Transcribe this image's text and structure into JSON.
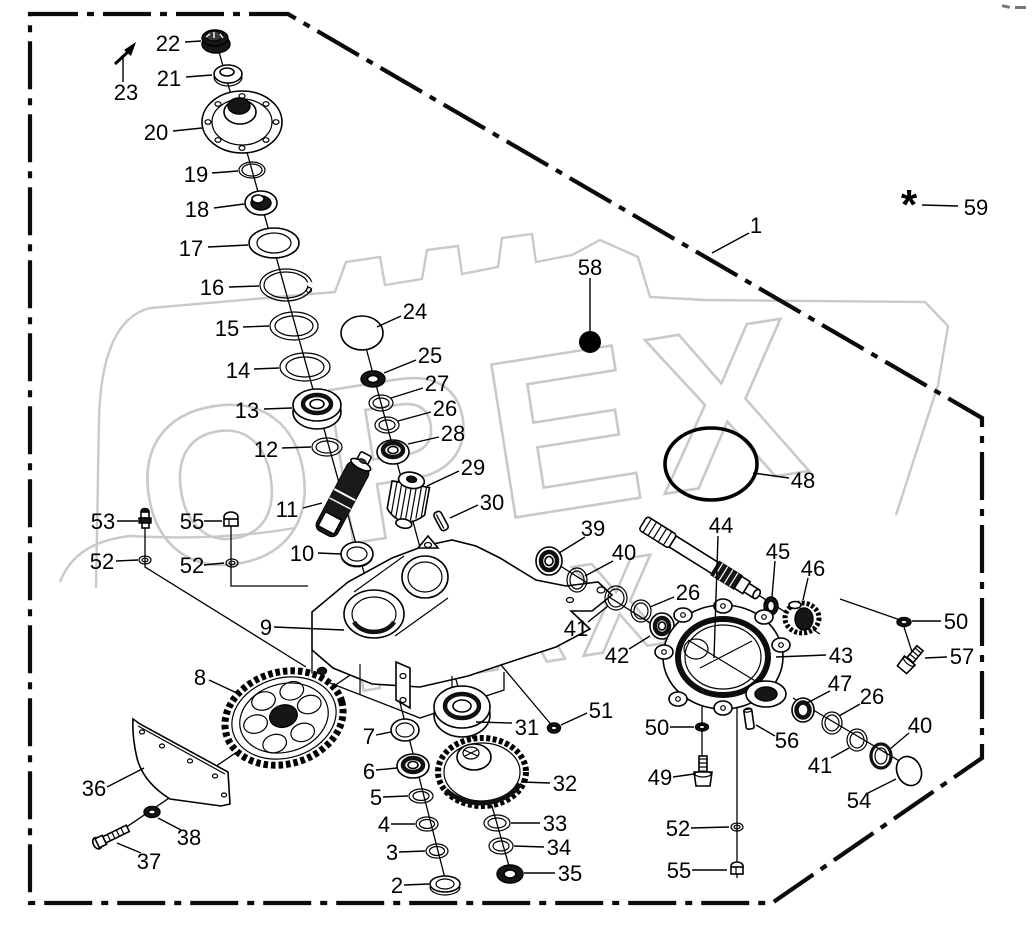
{
  "diagram": {
    "type": "exploded-parts-diagram",
    "subject": "gearbox assembly",
    "border_style": "dash-dot",
    "line_color": "#000000",
    "background": "#ffffff"
  },
  "watermark": {
    "line1": "OPEX",
    "line2": "MAX",
    "color": "#c9c9c9"
  },
  "footnote": {
    "symbol": "*"
  },
  "labels": [
    {
      "n": "22",
      "x": 168,
      "y": 43,
      "x1": 185,
      "y1": 42,
      "x2": 201,
      "y2": 41
    },
    {
      "n": "21",
      "x": 169,
      "y": 78,
      "x1": 186,
      "y1": 77,
      "x2": 212,
      "y2": 75
    },
    {
      "n": "23",
      "x": 126,
      "y": 92,
      "x1": 123,
      "y1": 82,
      "x2": 123,
      "y2": 58
    },
    {
      "n": "20",
      "x": 156,
      "y": 132,
      "x1": 173,
      "y1": 131,
      "x2": 202,
      "y2": 128
    },
    {
      "n": "19",
      "x": 196,
      "y": 174,
      "x1": 212,
      "y1": 173,
      "x2": 238,
      "y2": 171
    },
    {
      "n": "18",
      "x": 197,
      "y": 209,
      "x1": 214,
      "y1": 208,
      "x2": 244,
      "y2": 204
    },
    {
      "n": "17",
      "x": 191,
      "y": 248,
      "x1": 208,
      "y1": 247,
      "x2": 248,
      "y2": 245
    },
    {
      "n": "16",
      "x": 212,
      "y": 287,
      "x1": 229,
      "y1": 287,
      "x2": 259,
      "y2": 286
    },
    {
      "n": "15",
      "x": 227,
      "y": 328,
      "x1": 243,
      "y1": 327,
      "x2": 269,
      "y2": 326
    },
    {
      "n": "14",
      "x": 238,
      "y": 370,
      "x1": 254,
      "y1": 369,
      "x2": 279,
      "y2": 368
    },
    {
      "n": "13",
      "x": 247,
      "y": 410,
      "x1": 264,
      "y1": 409,
      "x2": 292,
      "y2": 408
    },
    {
      "n": "12",
      "x": 266,
      "y": 449,
      "x1": 282,
      "y1": 448,
      "x2": 311,
      "y2": 447
    },
    {
      "n": "11",
      "x": 287,
      "y": 509,
      "x1": 303,
      "y1": 508,
      "x2": 322,
      "y2": 503
    },
    {
      "n": "10",
      "x": 302,
      "y": 553,
      "x1": 318,
      "y1": 553,
      "x2": 341,
      "y2": 554
    },
    {
      "n": "24",
      "x": 415,
      "y": 311,
      "x1": 401,
      "y1": 316,
      "x2": 377,
      "y2": 327
    },
    {
      "n": "25",
      "x": 430,
      "y": 355,
      "x1": 416,
      "y1": 360,
      "x2": 384,
      "y2": 373
    },
    {
      "n": "27",
      "x": 437,
      "y": 383,
      "x1": 423,
      "y1": 388,
      "x2": 391,
      "y2": 398
    },
    {
      "n": "26",
      "x": 445,
      "y": 408,
      "x1": 431,
      "y1": 412,
      "x2": 398,
      "y2": 421
    },
    {
      "n": "28",
      "x": 453,
      "y": 433,
      "x1": 439,
      "y1": 437,
      "x2": 408,
      "y2": 444
    },
    {
      "n": "29",
      "x": 473,
      "y": 467,
      "x1": 459,
      "y1": 471,
      "x2": 427,
      "y2": 486
    },
    {
      "n": "30",
      "x": 492,
      "y": 502,
      "x1": 478,
      "y1": 505,
      "x2": 450,
      "y2": 518
    },
    {
      "n": "9",
      "x": 266,
      "y": 627,
      "x1": 274,
      "y1": 627,
      "x2": 344,
      "y2": 630
    },
    {
      "n": "53",
      "x": 103,
      "y": 521,
      "x1": 117,
      "y1": 521,
      "x2": 138,
      "y2": 521
    },
    {
      "n": "52",
      "x": 102,
      "y": 561,
      "x1": 116,
      "y1": 561,
      "x2": 138,
      "y2": 560
    },
    {
      "n": "55",
      "x": 192,
      "y": 521,
      "x1": 204,
      "y1": 521,
      "x2": 222,
      "y2": 521
    },
    {
      "n": "52",
      "x": 192,
      "y": 565,
      "x1": 204,
      "y1": 565,
      "x2": 224,
      "y2": 563
    },
    {
      "n": "8",
      "x": 200,
      "y": 677,
      "x1": 209,
      "y1": 680,
      "x2": 239,
      "y2": 694
    },
    {
      "n": "36",
      "x": 94,
      "y": 788,
      "x1": 107,
      "y1": 787,
      "x2": 144,
      "y2": 768
    },
    {
      "n": "38",
      "x": 189,
      "y": 837,
      "x1": 181,
      "y1": 830,
      "x2": 158,
      "y2": 818
    },
    {
      "n": "37",
      "x": 149,
      "y": 861,
      "x1": 141,
      "y1": 853,
      "x2": 117,
      "y2": 843
    },
    {
      "n": "7",
      "x": 369,
      "y": 736,
      "x1": 376,
      "y1": 735,
      "x2": 391,
      "y2": 732
    },
    {
      "n": "6",
      "x": 369,
      "y": 771,
      "x1": 376,
      "y1": 770,
      "x2": 397,
      "y2": 768
    },
    {
      "n": "5",
      "x": 376,
      "y": 797,
      "x1": 383,
      "y1": 797,
      "x2": 408,
      "y2": 796
    },
    {
      "n": "4",
      "x": 384,
      "y": 824,
      "x1": 391,
      "y1": 824,
      "x2": 415,
      "y2": 824
    },
    {
      "n": "3",
      "x": 392,
      "y": 852,
      "x1": 399,
      "y1": 852,
      "x2": 425,
      "y2": 851
    },
    {
      "n": "2",
      "x": 397,
      "y": 885,
      "x1": 404,
      "y1": 885,
      "x2": 429,
      "y2": 884
    },
    {
      "n": "31",
      "x": 527,
      "y": 727,
      "x1": 512,
      "y1": 723,
      "x2": 476,
      "y2": 722
    },
    {
      "n": "32",
      "x": 565,
      "y": 783,
      "x1": 550,
      "y1": 783,
      "x2": 521,
      "y2": 782
    },
    {
      "n": "33",
      "x": 555,
      "y": 823,
      "x1": 540,
      "y1": 823,
      "x2": 511,
      "y2": 823
    },
    {
      "n": "34",
      "x": 559,
      "y": 847,
      "x1": 544,
      "y1": 847,
      "x2": 514,
      "y2": 846
    },
    {
      "n": "35",
      "x": 570,
      "y": 873,
      "x1": 555,
      "y1": 873,
      "x2": 524,
      "y2": 873
    },
    {
      "n": "51",
      "x": 601,
      "y": 710,
      "x1": 587,
      "y1": 713,
      "x2": 561,
      "y2": 725
    },
    {
      "n": "58",
      "x": 590,
      "y": 267,
      "x1": 590,
      "y1": 278,
      "x2": 590,
      "y2": 331
    },
    {
      "n": "1",
      "x": 756,
      "y": 225,
      "x1": 749,
      "y1": 233,
      "x2": 712,
      "y2": 253
    },
    {
      "n": "59",
      "x": 976,
      "y": 207,
      "x1": 958,
      "y1": 206,
      "x2": 922,
      "y2": 205
    },
    {
      "n": "48",
      "x": 803,
      "y": 480,
      "x1": 789,
      "y1": 478,
      "x2": 753,
      "y2": 473
    },
    {
      "n": "39",
      "x": 593,
      "y": 528,
      "x1": 585,
      "y1": 537,
      "x2": 559,
      "y2": 553
    },
    {
      "n": "40",
      "x": 624,
      "y": 552,
      "x1": 613,
      "y1": 561,
      "x2": 585,
      "y2": 576
    },
    {
      "n": "41",
      "x": 576,
      "y": 628,
      "x1": 588,
      "y1": 622,
      "x2": 608,
      "y2": 606
    },
    {
      "n": "26",
      "x": 688,
      "y": 592,
      "x1": 674,
      "y1": 597,
      "x2": 650,
      "y2": 607
    },
    {
      "n": "42",
      "x": 617,
      "y": 655,
      "x1": 629,
      "y1": 649,
      "x2": 650,
      "y2": 636
    },
    {
      "n": "44",
      "x": 721,
      "y": 525,
      "x1": 718,
      "y1": 536,
      "x2": 714,
      "y2": 658
    },
    {
      "n": "45",
      "x": 778,
      "y": 551,
      "x1": 775,
      "y1": 561,
      "x2": 772,
      "y2": 597
    },
    {
      "n": "46",
      "x": 813,
      "y": 568,
      "x1": 808,
      "y1": 578,
      "x2": 803,
      "y2": 600
    },
    {
      "n": "43",
      "x": 841,
      "y": 655,
      "x1": 826,
      "y1": 655,
      "x2": 776,
      "y2": 657
    },
    {
      "n": "50",
      "x": 956,
      "y": 621,
      "x1": 941,
      "y1": 621,
      "x2": 912,
      "y2": 621
    },
    {
      "n": "57",
      "x": 962,
      "y": 656,
      "x1": 947,
      "y1": 657,
      "x2": 925,
      "y2": 658
    },
    {
      "n": "47",
      "x": 840,
      "y": 683,
      "x1": 830,
      "y1": 691,
      "x2": 807,
      "y2": 703
    },
    {
      "n": "26",
      "x": 872,
      "y": 696,
      "x1": 860,
      "y1": 704,
      "x2": 839,
      "y2": 716
    },
    {
      "n": "41",
      "x": 820,
      "y": 765,
      "x1": 831,
      "y1": 758,
      "x2": 849,
      "y2": 748
    },
    {
      "n": "40",
      "x": 920,
      "y": 725,
      "x1": 909,
      "y1": 733,
      "x2": 890,
      "y2": 749
    },
    {
      "n": "54",
      "x": 859,
      "y": 800,
      "x1": 868,
      "y1": 793,
      "x2": 896,
      "y2": 779
    },
    {
      "n": "56",
      "x": 787,
      "y": 740,
      "x1": 775,
      "y1": 736,
      "x2": 756,
      "y2": 725
    },
    {
      "n": "50",
      "x": 657,
      "y": 727,
      "x1": 670,
      "y1": 727,
      "x2": 694,
      "y2": 727
    },
    {
      "n": "49",
      "x": 660,
      "y": 777,
      "x1": 673,
      "y1": 777,
      "x2": 694,
      "y2": 774
    },
    {
      "n": "52",
      "x": 678,
      "y": 828,
      "x1": 691,
      "y1": 828,
      "x2": 729,
      "y2": 827
    },
    {
      "n": "55",
      "x": 679,
      "y": 870,
      "x1": 692,
      "y1": 870,
      "x2": 727,
      "y2": 870
    }
  ]
}
